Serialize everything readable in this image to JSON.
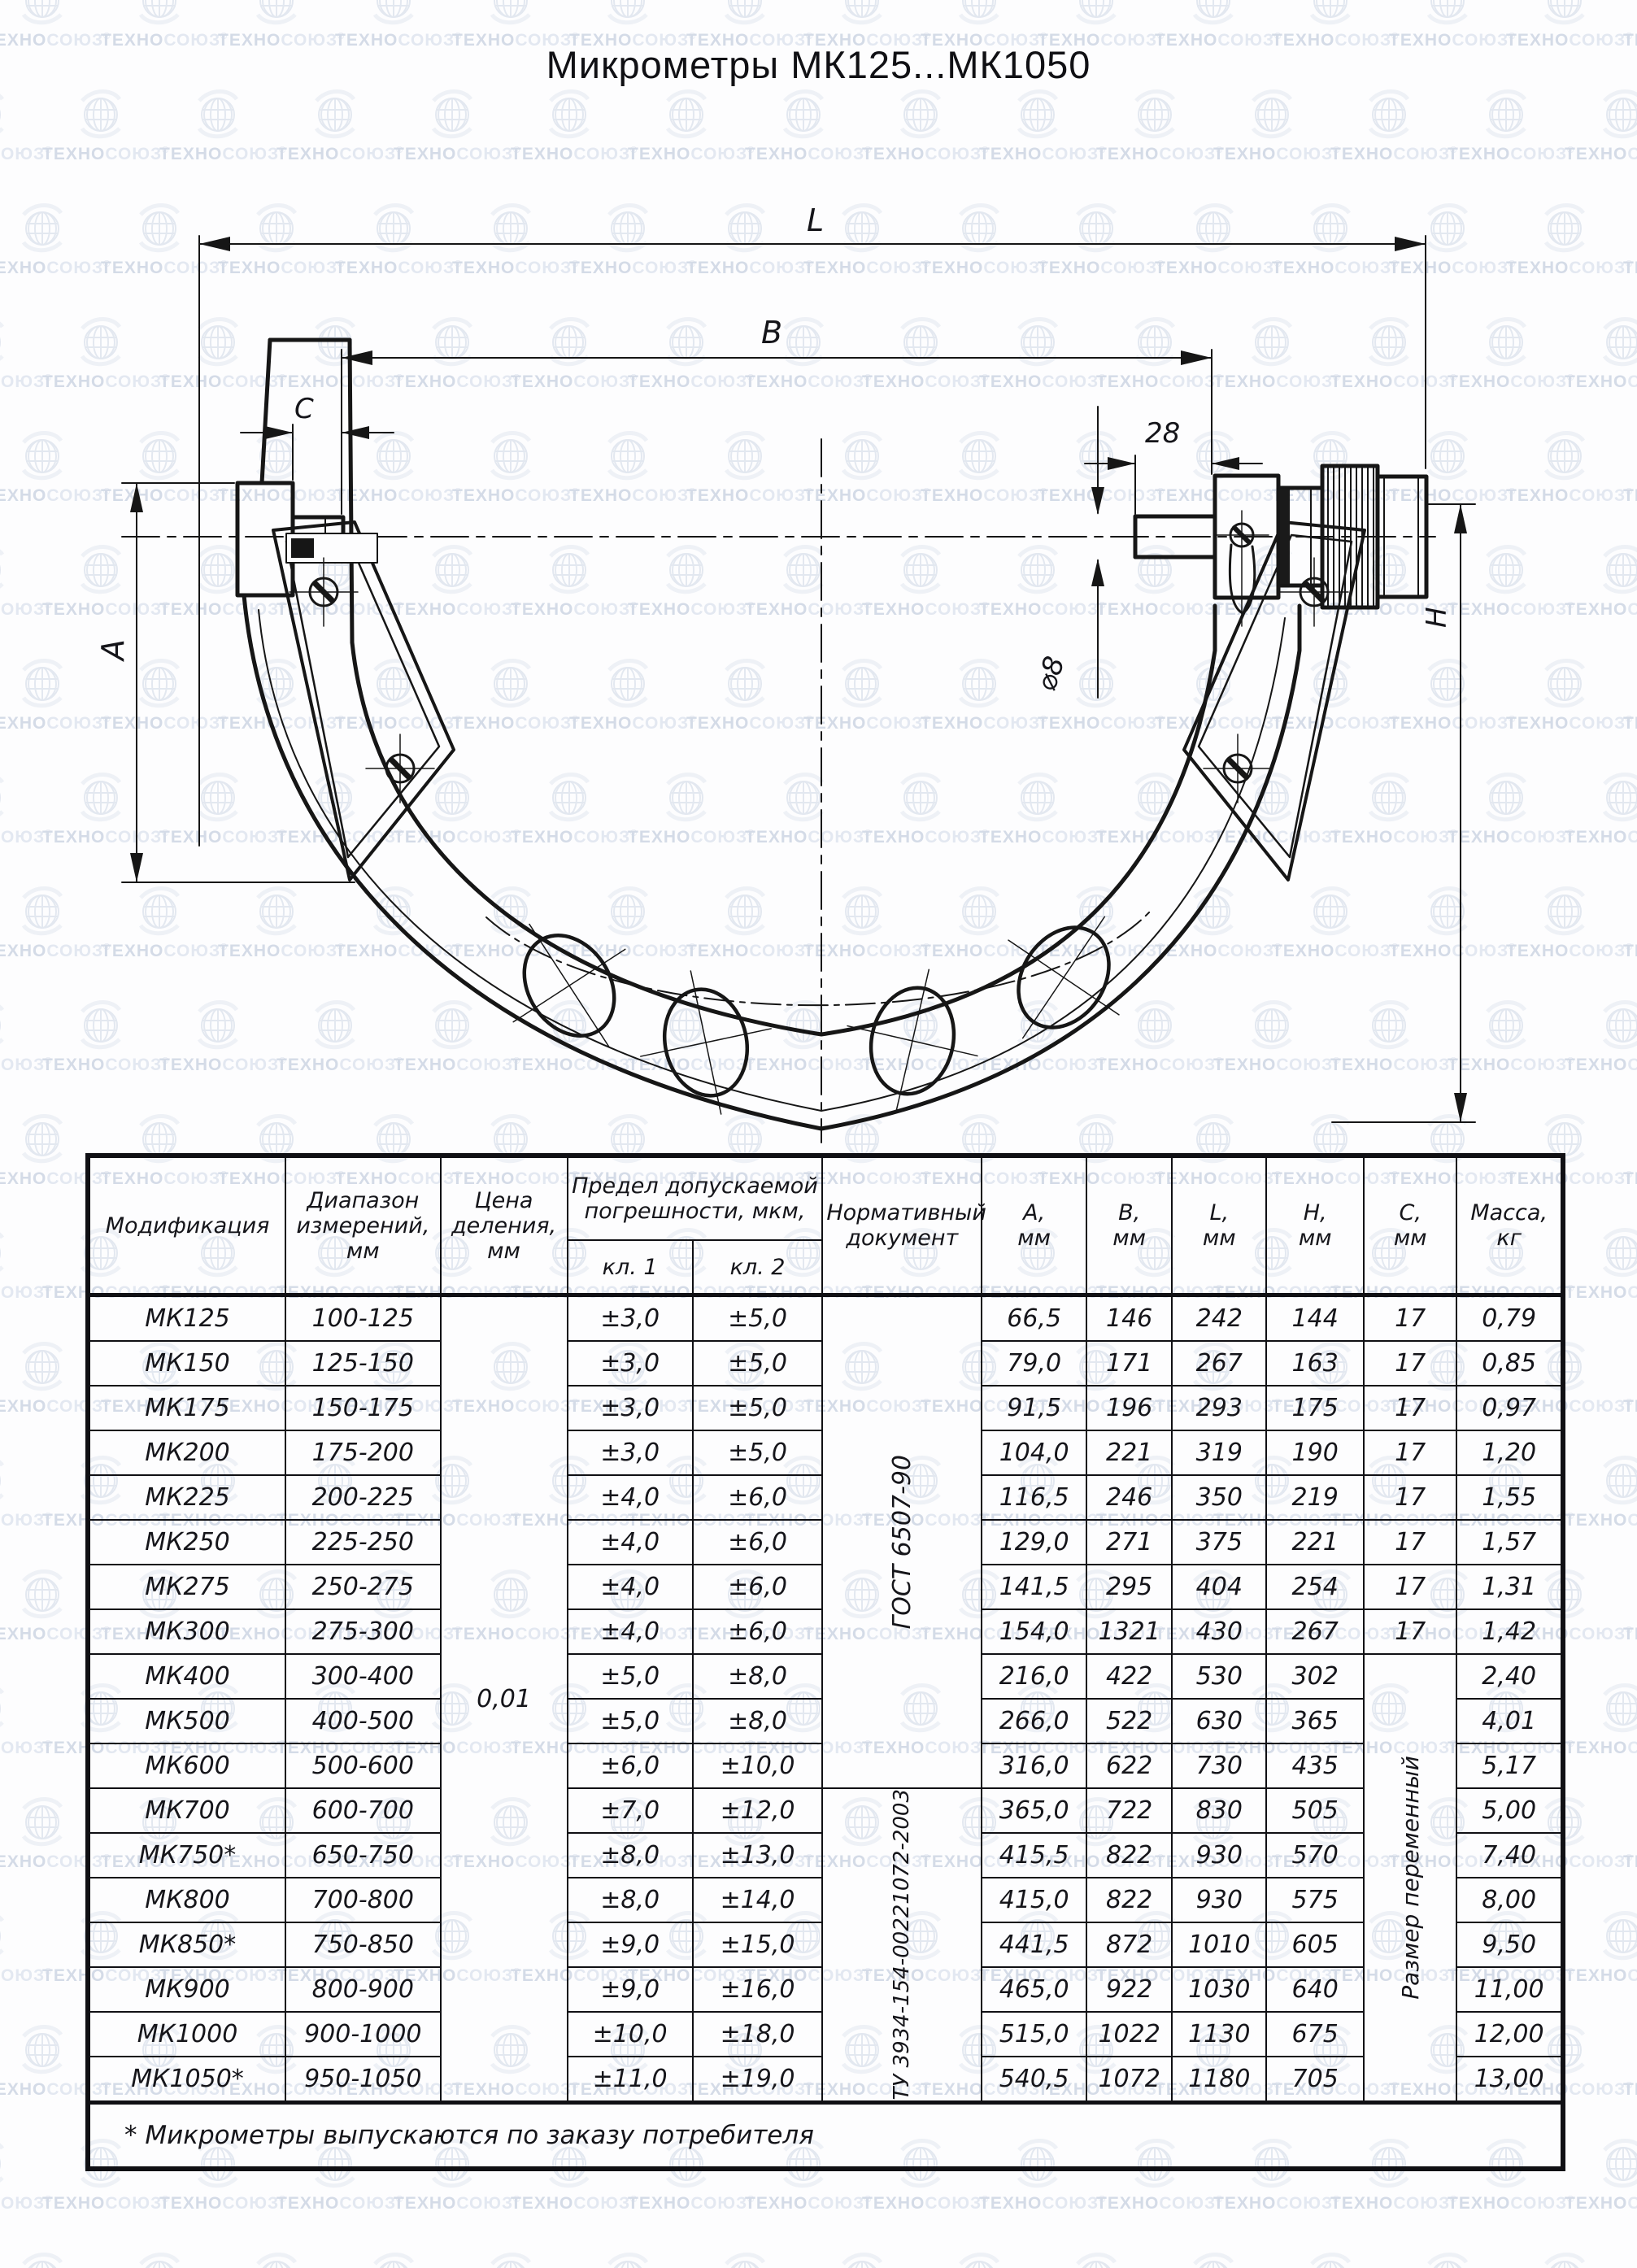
{
  "title": "Микрометры МК125...МК1050",
  "watermark": {
    "brand_bold": "ТЕХНО",
    "brand_light": "СОЮЗ",
    "registered": "®"
  },
  "drawing": {
    "labels": {
      "length_L": "L",
      "width_B": "B",
      "anvil_C": "C",
      "dim_28": "28",
      "spindle_dia": "⌀8",
      "height_A": "A",
      "height_H": "Н"
    }
  },
  "table": {
    "col_widths": [
      13.4,
      10.5,
      8.6,
      8.5,
      8.8,
      10.8,
      7.1,
      5.8,
      6.4,
      6.6,
      6.3,
      7.2
    ],
    "headers": {
      "modification": "Модификация",
      "range": "Диапазон\nизмерений,\nмм",
      "division": "Цена\nделения,\nмм",
      "error_limit": "Предел допускаемой\nпогрешности, мкм,",
      "class1": "кл. 1",
      "class2": "кл. 2",
      "normative": "Нормативный\nдокумент",
      "A": "А,\nмм",
      "B": "В,\nмм",
      "L": "L,\nмм",
      "H": "Н,\nмм",
      "C": "С,\nмм",
      "mass": "Масса,\nкг"
    },
    "division_value": "0,01",
    "normative_docs": [
      {
        "text": "ГОСТ 6507-90",
        "row_start": 0,
        "row_count": 11
      },
      {
        "text": "ТУ 3934-154-00221072-2003",
        "row_start": 11,
        "row_count": 7
      }
    ],
    "c_variable": {
      "text": "Размер переменный",
      "row_start": 8,
      "row_count": 10
    },
    "rows": [
      {
        "mod": "МК125",
        "range": "100-125",
        "kl1": "±3,0",
        "kl2": "±5,0",
        "A": "66,5",
        "B": "146",
        "L": "242",
        "H": "144",
        "C": "17",
        "mass": "0,79"
      },
      {
        "mod": "МК150",
        "range": "125-150",
        "kl1": "±3,0",
        "kl2": "±5,0",
        "A": "79,0",
        "B": "171",
        "L": "267",
        "H": "163",
        "C": "17",
        "mass": "0,85"
      },
      {
        "mod": "МК175",
        "range": "150-175",
        "kl1": "±3,0",
        "kl2": "±5,0",
        "A": "91,5",
        "B": "196",
        "L": "293",
        "H": "175",
        "C": "17",
        "mass": "0,97"
      },
      {
        "mod": "МК200",
        "range": "175-200",
        "kl1": "±3,0",
        "kl2": "±5,0",
        "A": "104,0",
        "B": "221",
        "L": "319",
        "H": "190",
        "C": "17",
        "mass": "1,20"
      },
      {
        "mod": "МК225",
        "range": "200-225",
        "kl1": "±4,0",
        "kl2": "±6,0",
        "A": "116,5",
        "B": "246",
        "L": "350",
        "H": "219",
        "C": "17",
        "mass": "1,55"
      },
      {
        "mod": "МК250",
        "range": "225-250",
        "kl1": "±4,0",
        "kl2": "±6,0",
        "A": "129,0",
        "B": "271",
        "L": "375",
        "H": "221",
        "C": "17",
        "mass": "1,57"
      },
      {
        "mod": "МК275",
        "range": "250-275",
        "kl1": "±4,0",
        "kl2": "±6,0",
        "A": "141,5",
        "B": "295",
        "L": "404",
        "H": "254",
        "C": "17",
        "mass": "1,31"
      },
      {
        "mod": "МК300",
        "range": "275-300",
        "kl1": "±4,0",
        "kl2": "±6,0",
        "A": "154,0",
        "B": "1321",
        "L": "430",
        "H": "267",
        "C": "17",
        "mass": "1,42"
      },
      {
        "mod": "МК400",
        "range": "300-400",
        "kl1": "±5,0",
        "kl2": "±8,0",
        "A": "216,0",
        "B": "422",
        "L": "530",
        "H": "302",
        "mass": "2,40"
      },
      {
        "mod": "МК500",
        "range": "400-500",
        "kl1": "±5,0",
        "kl2": "±8,0",
        "A": "266,0",
        "B": "522",
        "L": "630",
        "H": "365",
        "mass": "4,01"
      },
      {
        "mod": "МК600",
        "range": "500-600",
        "kl1": "±6,0",
        "kl2": "±10,0",
        "A": "316,0",
        "B": "622",
        "L": "730",
        "H": "435",
        "mass": "5,17"
      },
      {
        "mod": "МК700",
        "range": "600-700",
        "kl1": "±7,0",
        "kl2": "±12,0",
        "A": "365,0",
        "B": "722",
        "L": "830",
        "H": "505",
        "mass": "5,00"
      },
      {
        "mod": "МК750*",
        "range": "650-750",
        "kl1": "±8,0",
        "kl2": "±13,0",
        "A": "415,5",
        "B": "822",
        "L": "930",
        "H": "570",
        "mass": "7,40"
      },
      {
        "mod": "МК800",
        "range": "700-800",
        "kl1": "±8,0",
        "kl2": "±14,0",
        "A": "415,0",
        "B": "822",
        "L": "930",
        "H": "575",
        "mass": "8,00"
      },
      {
        "mod": "МК850*",
        "range": "750-850",
        "kl1": "±9,0",
        "kl2": "±15,0",
        "A": "441,5",
        "B": "872",
        "L": "1010",
        "H": "605",
        "mass": "9,50"
      },
      {
        "mod": "МК900",
        "range": "800-900",
        "kl1": "±9,0",
        "kl2": "±16,0",
        "A": "465,0",
        "B": "922",
        "L": "1030",
        "H": "640",
        "mass": "11,00"
      },
      {
        "mod": "МК1000",
        "range": "900-1000",
        "kl1": "±10,0",
        "kl2": "±18,0",
        "A": "515,0",
        "B": "1022",
        "L": "1130",
        "H": "675",
        "mass": "12,00"
      },
      {
        "mod": "МК1050*",
        "range": "950-1050",
        "kl1": "±11,0",
        "kl2": "±19,0",
        "A": "540,5",
        "B": "1072",
        "L": "1180",
        "H": "705",
        "mass": "13,00"
      }
    ],
    "footnote": "* Микрометры выпускаются по заказу потребителя"
  }
}
